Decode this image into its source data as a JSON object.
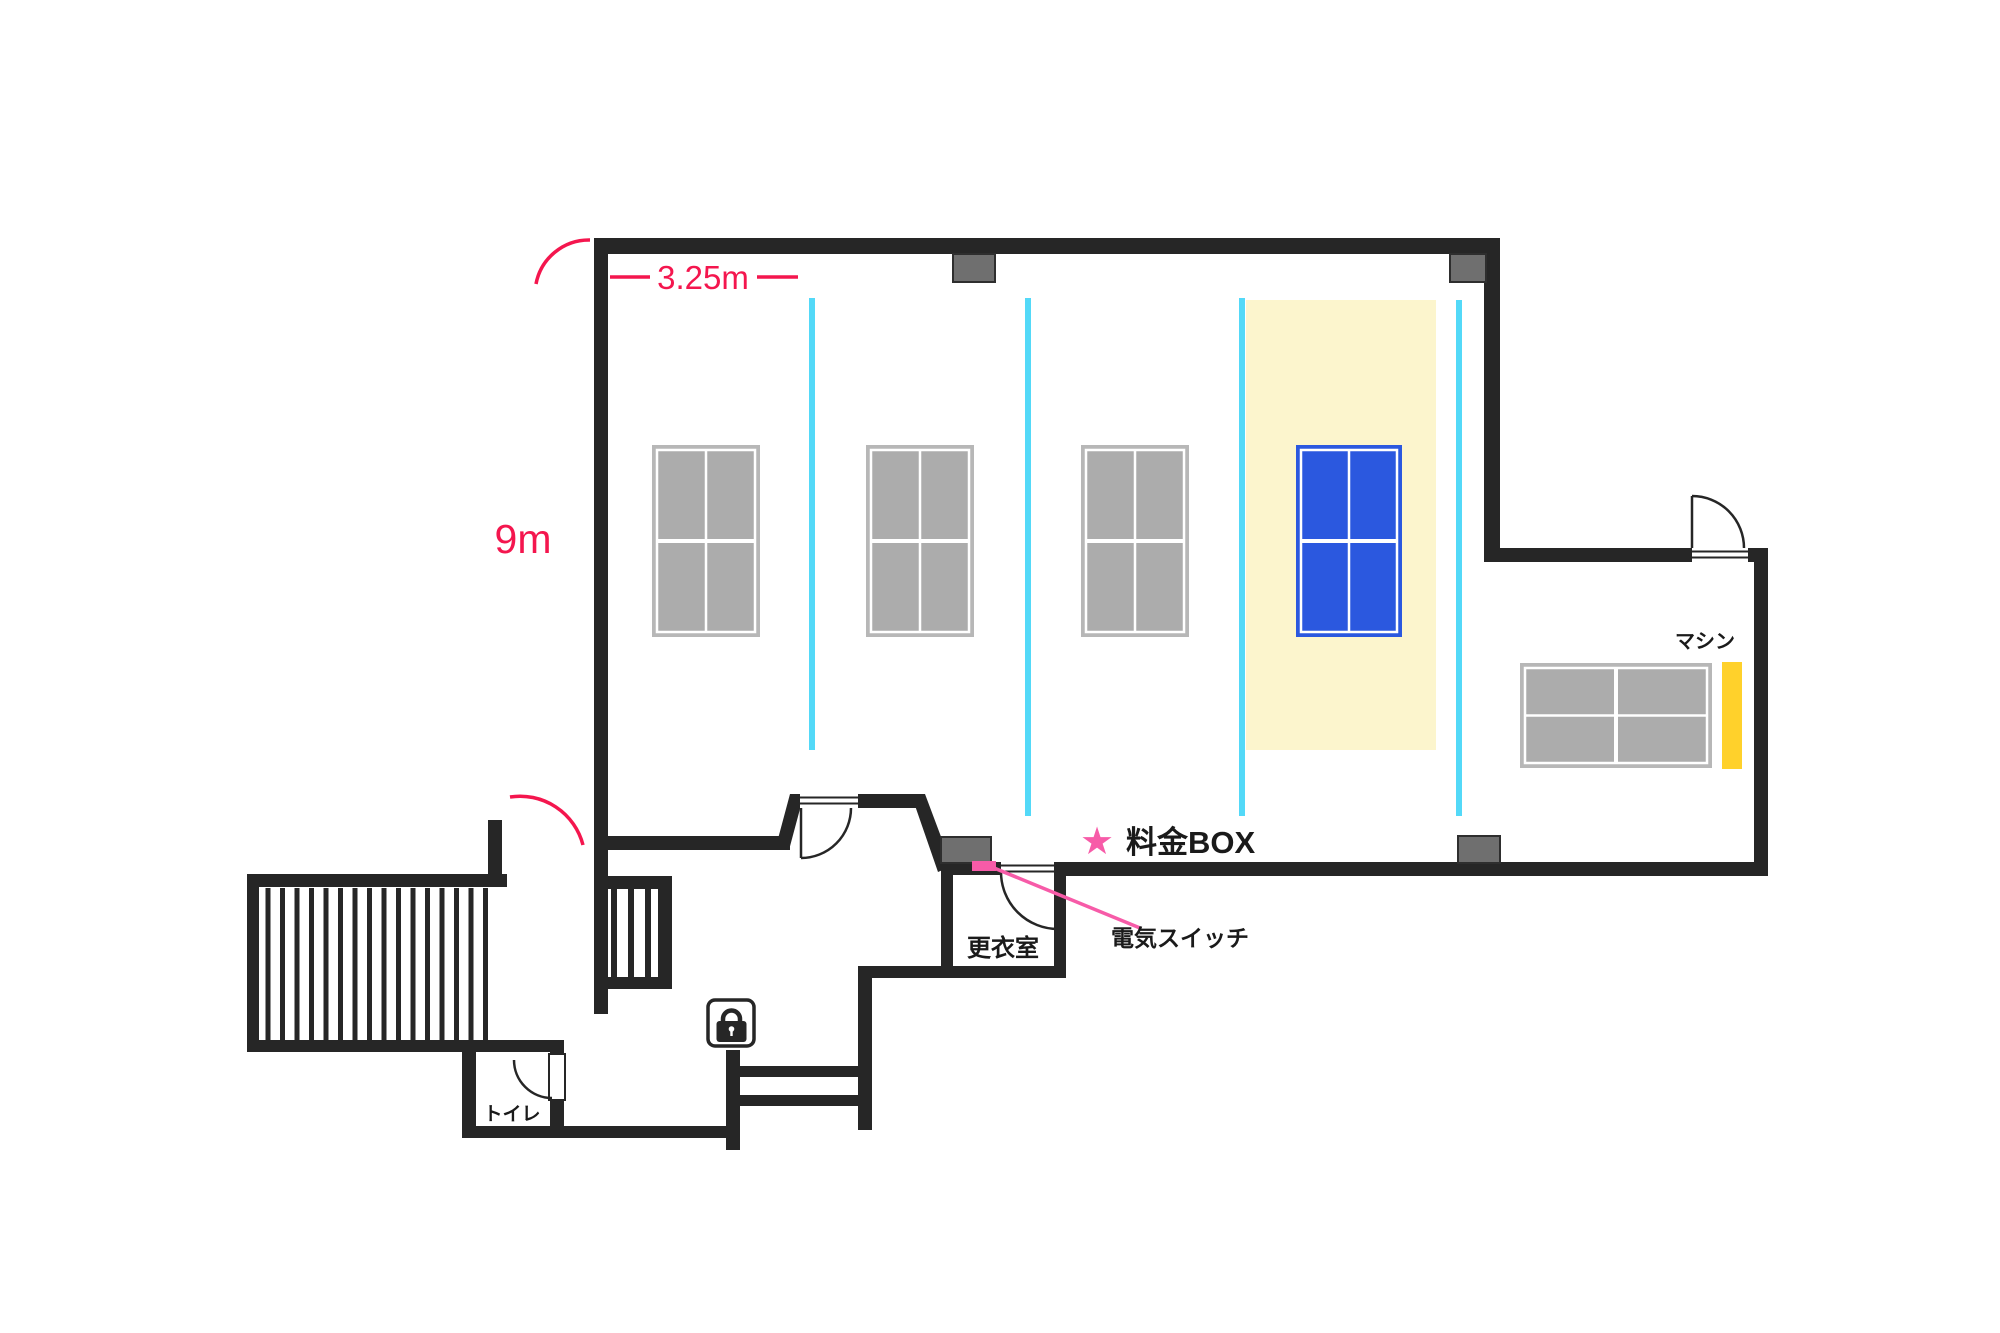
{
  "colors": {
    "wall": "#262626",
    "dimension_red": "#F4164E",
    "accent_pink": "#F75BA8",
    "court_divider_cyan": "#53D9F8",
    "court_highlight_yellow": "#FCF5CD",
    "table_gray": "#ACACAC",
    "table_blue": "#2B58DF",
    "machine_strip_yellow": "#FFD12B",
    "pillar_gray": "#6F6F6F"
  },
  "dimension_labels": {
    "width": "3.25m",
    "height": "9m"
  },
  "annotations": {
    "fee_box_star": "★",
    "fee_box": "料金BOX",
    "light_switch": "電気スイッチ",
    "machine": "マシン"
  },
  "rooms": {
    "changing_room": "更衣室",
    "toilet": "トイレ"
  }
}
